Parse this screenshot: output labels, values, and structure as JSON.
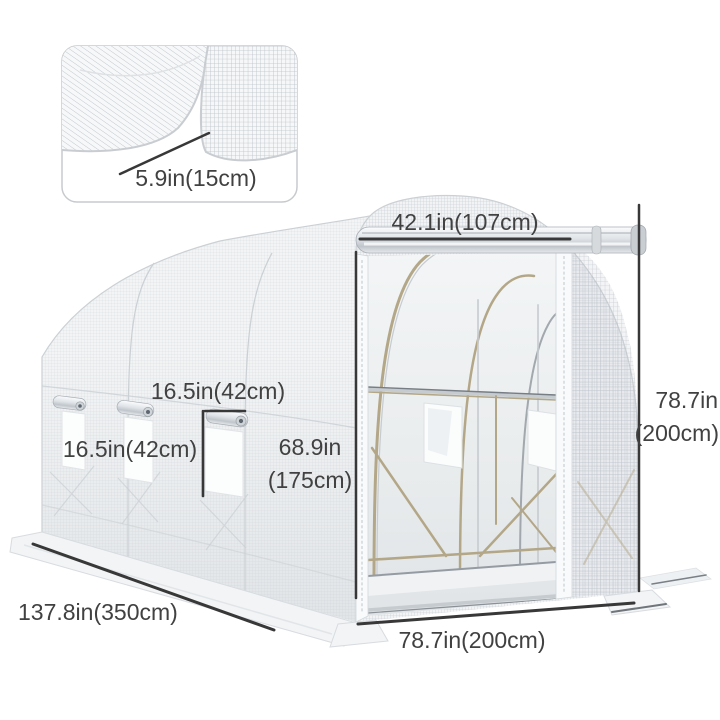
{
  "inset_detail": {
    "mesh_pitch_label": "5.9in(15cm)"
  },
  "annotations": {
    "door_width": "42.1in(107cm)",
    "overall_height": {
      "in": "78.7in",
      "cm": "(200cm)"
    },
    "window_width": "16.5in(42cm)",
    "window_height": "16.5in(42cm)",
    "door_height": {
      "in": "68.9in",
      "cm": "(175cm)"
    },
    "tunnel_length": "137.8in(350cm)",
    "tunnel_width": "78.7in(200cm)"
  },
  "colors": {
    "background": "#ffffff",
    "annotation_text": "#414141",
    "dimension_line": "#383838",
    "fabric_white": "#f2f4f5",
    "mesh_gray": "#aab1b9",
    "frame_tan": "#b3a788",
    "hardware_silver": "#c6cbd0",
    "interior_shade": "#e6e9ec"
  }
}
